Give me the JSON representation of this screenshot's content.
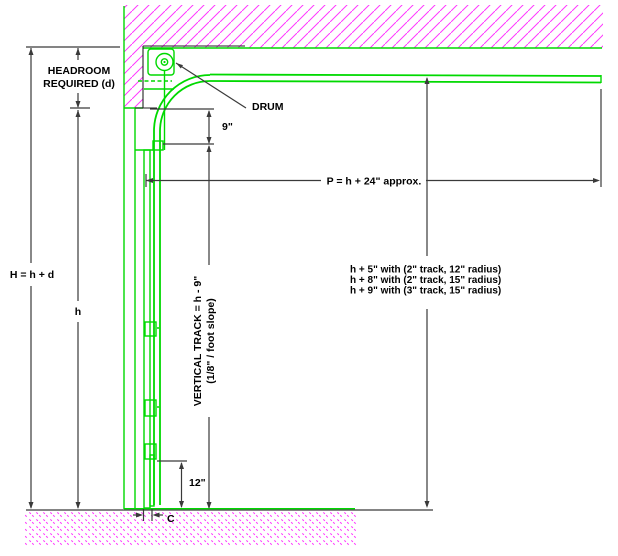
{
  "diagram_type": "sectional-overhead-door-headroom-section",
  "colors": {
    "track-green": "#00d900",
    "hatch-magenta": "#ff3dff",
    "dim-gray": "#3a3a3a",
    "text-black": "#000000",
    "bg": "#ffffff"
  },
  "labels": {
    "headroom": {
      "line1": "HEADROOM",
      "line2": "REQUIRED (d)"
    },
    "total_height": "H = h + d",
    "door_height": "h",
    "top_offset": "9\"",
    "horizontal_run": "P = h + 24\" approx.",
    "drum": "DRUM",
    "vertical_track": {
      "line1": "VERTICAL TRACK = h - 9\"",
      "line2": "(1/8\" / foot slope)"
    },
    "track_options": [
      "h + 5\" with (2\" track, 12\" radius)",
      "h + 8\" with (2\" track, 15\" radius)",
      "h + 9\" with (3\" track, 15\" radius)"
    ],
    "bottom_offset": "12\"",
    "clearance": "C"
  }
}
